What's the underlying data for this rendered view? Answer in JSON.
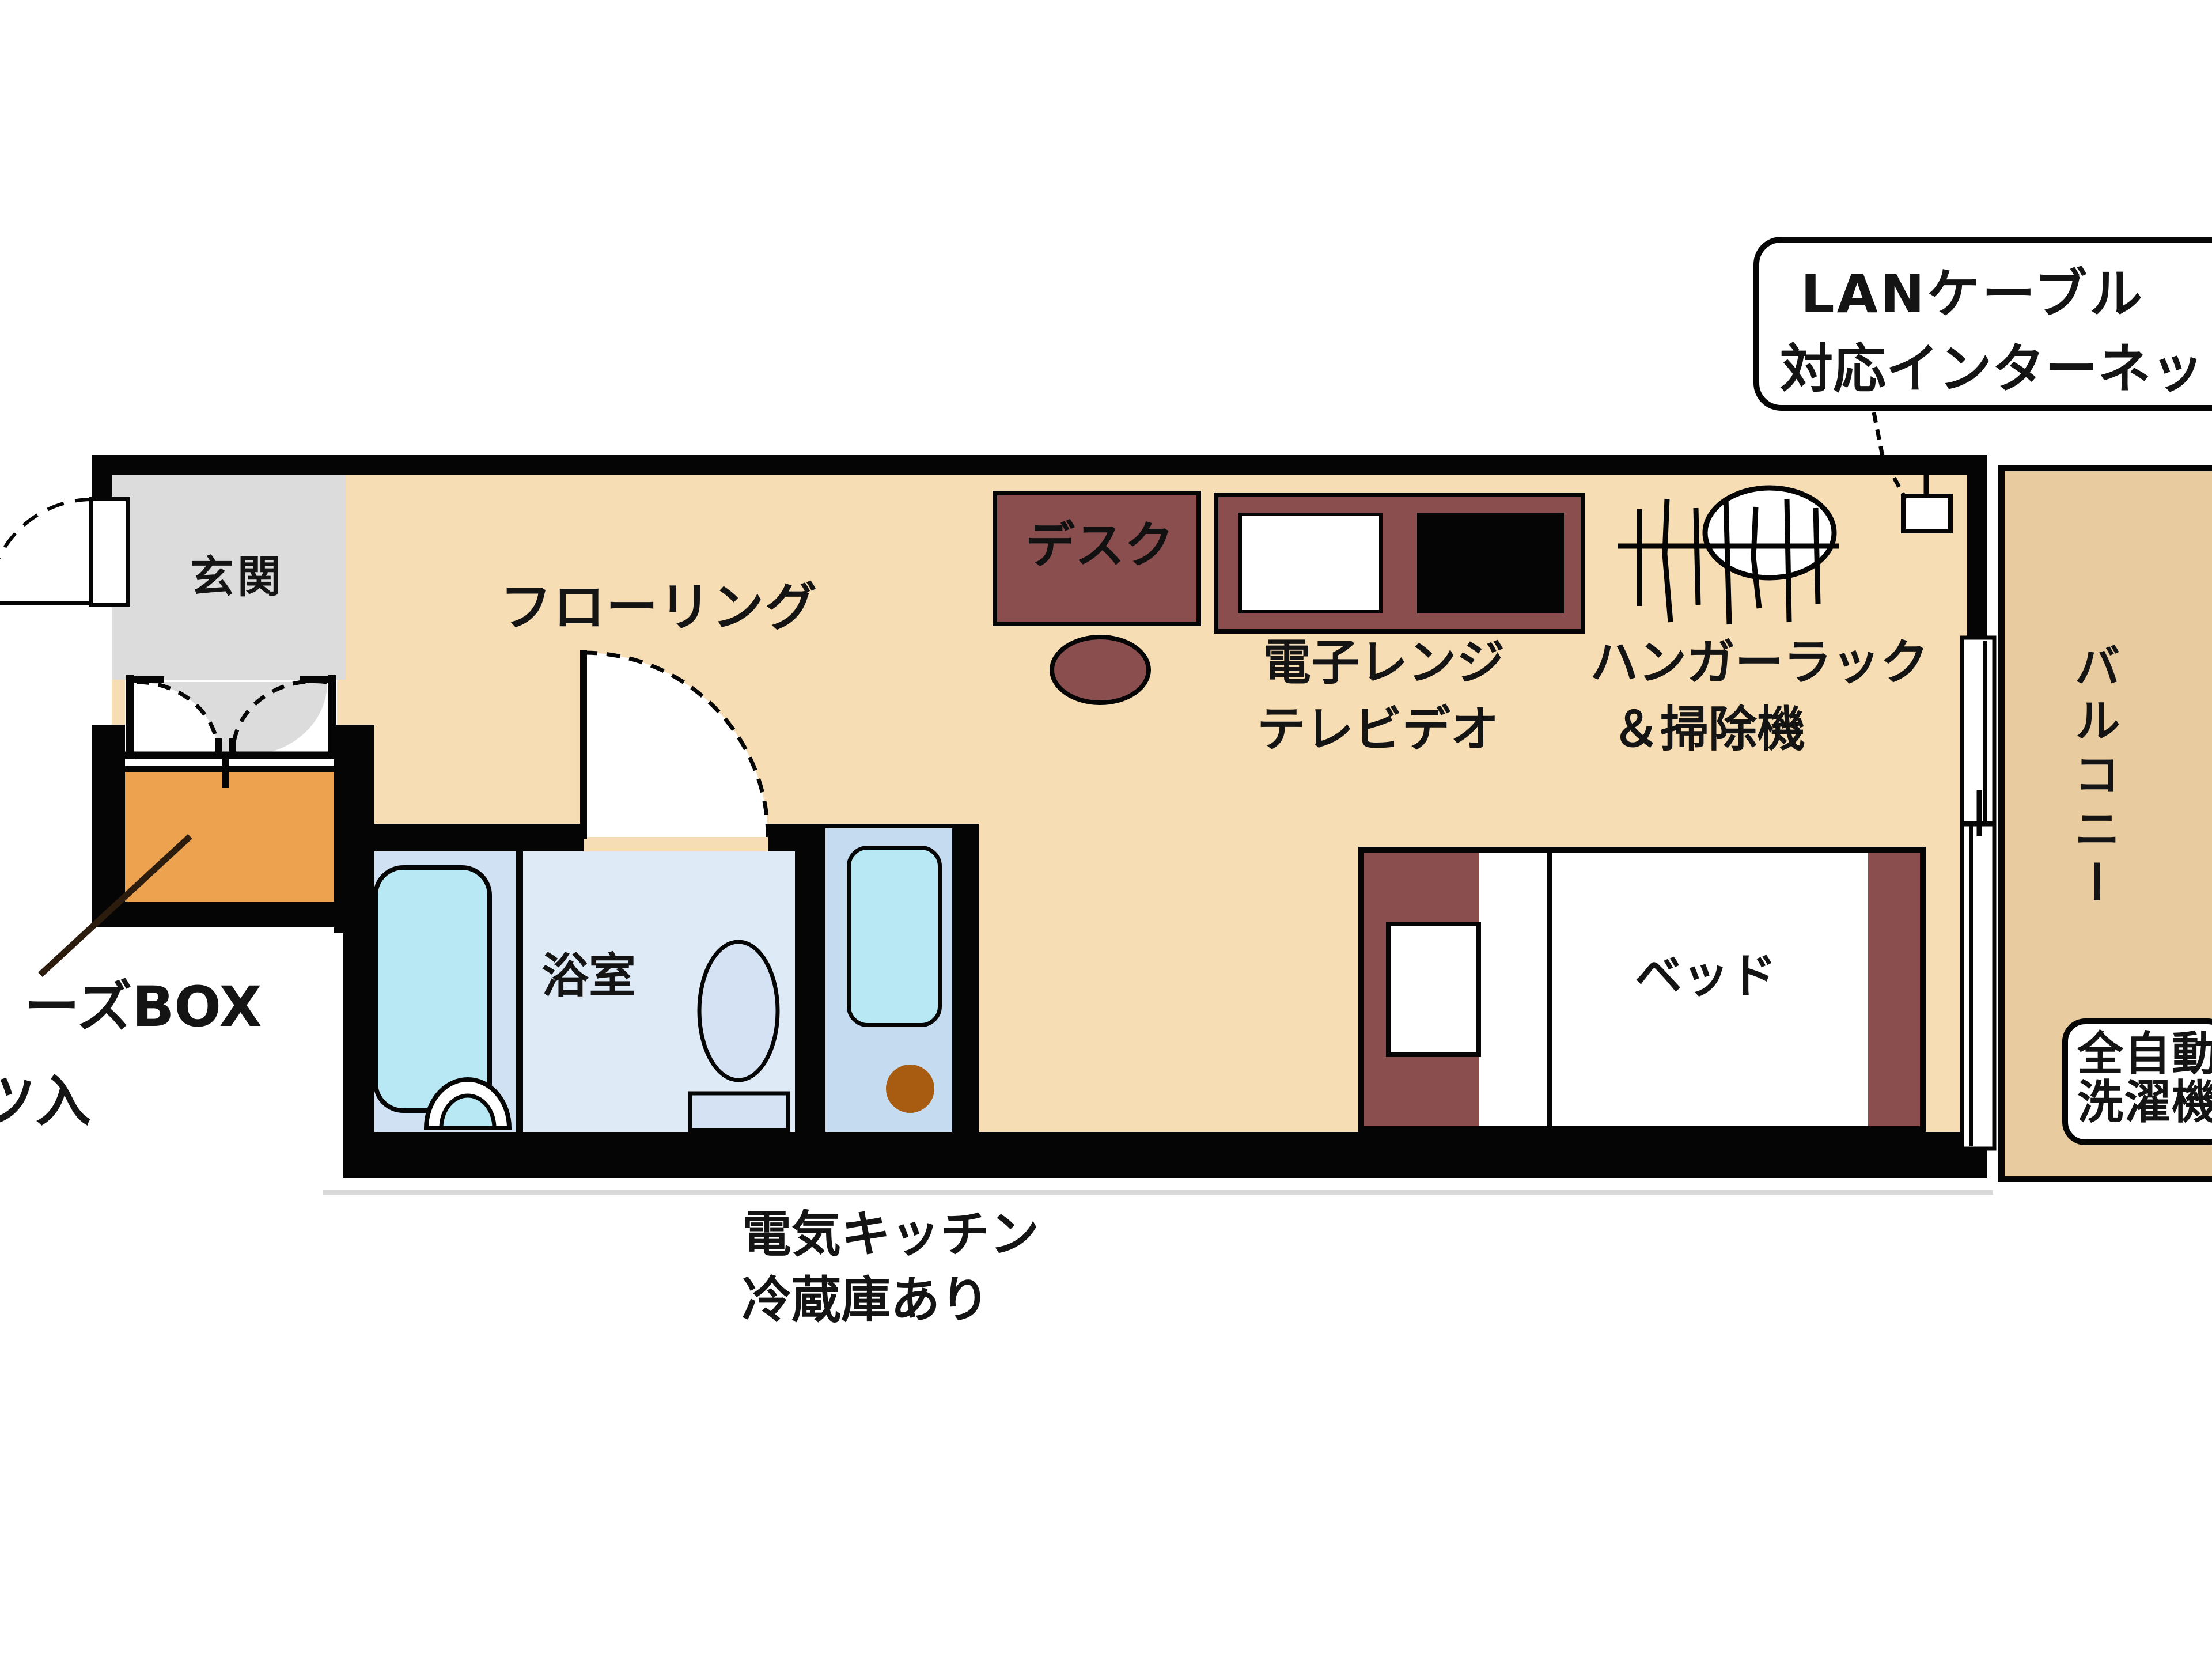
{
  "plan": {
    "title": "one-room apartment floor plan",
    "labels": {
      "genkan": "玄関",
      "flooring": "フローリング",
      "bathroom": "浴室",
      "balcony": "バルコニー",
      "desk": "デスク",
      "bed": "ベッド",
      "appliance_l1": "電子レンジ",
      "appliance_l2": "テレビデオ",
      "hanger_l1": "ハンガーラック",
      "hanger_l2": "＆掃除機",
      "kitchen_l1": "電気キッチン",
      "kitchen_l2": "冷蔵庫あり",
      "washer_l1": "全自動",
      "washer_l2": "洗濯機",
      "shoebox_l1": "ーズBOX",
      "shoebox_l2": "ツ入",
      "callout_l1": "LANケーブル",
      "callout_l2": "対応インターネット"
    },
    "colors": {
      "wall": "#050505",
      "room_floor": "#f6ddb4",
      "balcony_floor": "#e8cca0",
      "genkan_floor": "#dcdcdc",
      "shoebox": "#eca24e",
      "furniture_maroon": "#8b4e4f",
      "bath_fixture_cyan": "#b9e8f5",
      "bath_floor": "#cfe1f3",
      "toilet_floor": "#dfeaf7",
      "kitchen_floor": "#c5dcf0",
      "burner_brown": "#a85c12",
      "white": "#ffffff"
    }
  }
}
